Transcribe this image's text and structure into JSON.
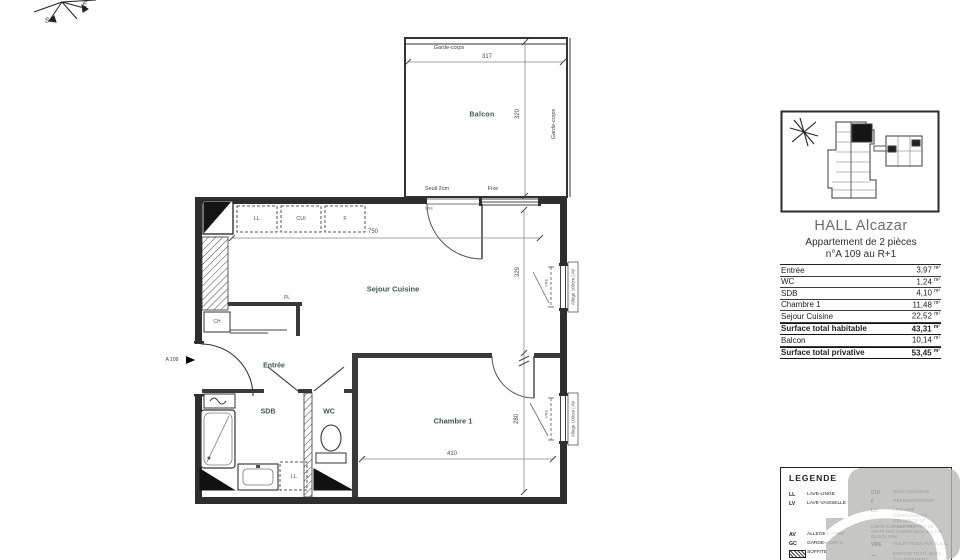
{
  "compass": {
    "e": "E",
    "s": "S"
  },
  "plan": {
    "balcon": {
      "label": "Balcon",
      "garde_corps": "Garde-corps",
      "width": "317",
      "depth": "320"
    },
    "sejour": {
      "label": "Sejour Cuisine",
      "width": "750",
      "depth": "329",
      "seuil": "Seuil 2cm",
      "fixe": "Fixe",
      "vre": "VRE"
    },
    "kitchen": {
      "ll": "LL",
      "cui": "CUI",
      "f": "F"
    },
    "entree": {
      "label": "Entrée",
      "pl": "PL",
      "ch": "CH",
      "unit": "A 109"
    },
    "sdb": {
      "label": "SDB",
      "ll": "LL"
    },
    "wc": {
      "label": "WC"
    },
    "chambre": {
      "label": "Chambre 1",
      "width": "410",
      "depth": "280"
    },
    "window": {
      "allege": "Allège 100cm | AV",
      "vre": "VRE"
    }
  },
  "panel": {
    "title": "HALL Alcazar",
    "subtitle": "Appartement de 2 pièces",
    "unit_line": "n°A 109 au R+1",
    "rows": [
      {
        "label": "Entrée",
        "value": "3,97",
        "unit": "m²"
      },
      {
        "label": "WC",
        "value": "1,24",
        "unit": "m²"
      },
      {
        "label": "SDB",
        "value": "4,10",
        "unit": "m²"
      },
      {
        "label": "Chambre 1",
        "value": "11,48",
        "unit": "m²"
      },
      {
        "label": "Sejour Cuisine",
        "value": "22,52",
        "unit": "m²"
      },
      {
        "label": "Surface total habitable",
        "value": "43,31",
        "unit": "m²"
      },
      {
        "label": "Balcon",
        "value": "10,14",
        "unit": "m²"
      },
      {
        "label": "Surface total privative",
        "value": "53,45",
        "unit": "m²"
      }
    ]
  },
  "legend": {
    "title": "LEGENDE",
    "left": [
      {
        "abbr": "LL",
        "desc": "LAVE-LINGE"
      },
      {
        "abbr": "LV",
        "desc": "LAVE-VAISSELLE"
      },
      {
        "abbr": "AV",
        "desc": "ALLEGE VITREE"
      },
      {
        "abbr": "GC",
        "desc": "GARDE-CORPS"
      },
      {
        "abbr": "",
        "desc": "SOFFITE"
      }
    ],
    "right": [
      {
        "abbr": "CUI",
        "desc": "BLOC CUISSON"
      },
      {
        "abbr": "F",
        "desc": "REFRIGERATEUR"
      },
      {
        "abbr": "LC",
        "desc": "LINEAIRE COMPLEMENT (DECENCE NF HABITAT)"
      },
      {
        "abbr": "",
        "desc": "LIMITE SUP. DES TRAPPES DE VISITE DES GAINES (Environ 1,70m DU SOL FINI)"
      },
      {
        "abbr": "VRE",
        "desc": "VOLET ROULANT ELEC."
      },
      {
        "abbr": "~",
        "desc": "ESPACE TECH. BLOC DU LOGEMENT"
      }
    ]
  },
  "colors": {
    "wall": "#2e2e2e",
    "room_label": "#3a5a46",
    "watermark": "#b9b9b5"
  }
}
